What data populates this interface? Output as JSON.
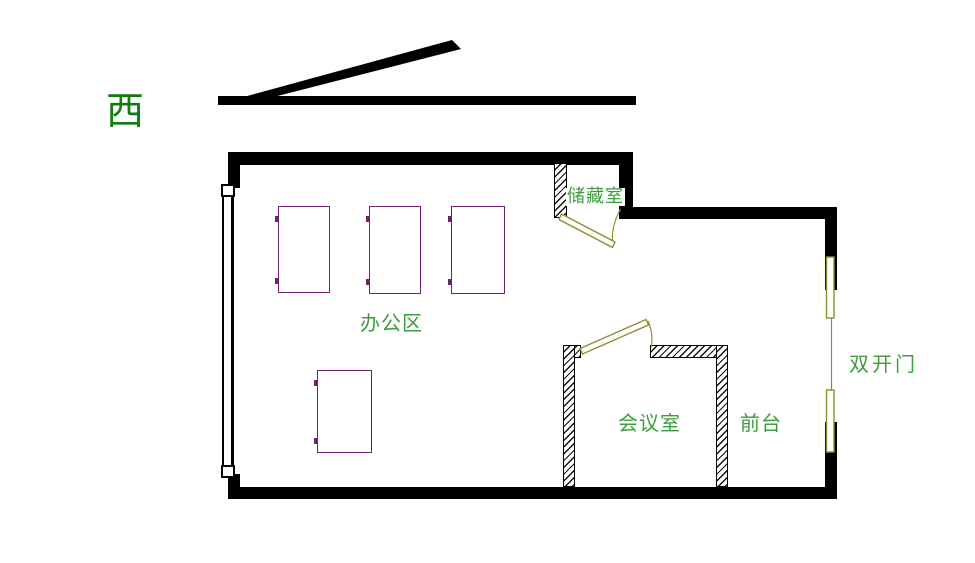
{
  "title": "office floor plan",
  "compass": {
    "west_label": "西"
  },
  "rooms": {
    "storage": {
      "label": "储藏室"
    },
    "office": {
      "label": "办公区"
    },
    "meeting": {
      "label": "会议室"
    },
    "reception": {
      "label": "前台"
    },
    "double_door": {
      "label": "双开门"
    }
  },
  "desks": {
    "count": 4
  },
  "colors": {
    "wall": "#000000",
    "door": "#8f8f2f",
    "desk": "#702070",
    "label_green": "#3c9e3c",
    "compass_green": "#0e7d0e",
    "background": "#ffffff"
  }
}
